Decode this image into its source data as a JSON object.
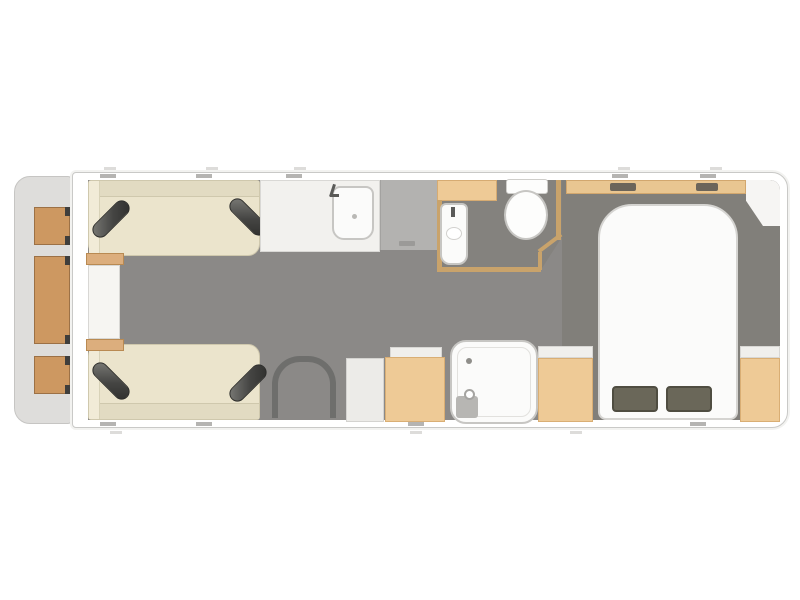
{
  "floorplan": {
    "type": "caravan-floorplan",
    "view": "top-down",
    "colors": {
      "front_body": "#dedddb",
      "body_wall": "#ffffff",
      "wall_outline": "#c9c9c7",
      "floor": "#8b8987",
      "floor_bedroom": "#817f7a",
      "floor_washroom": "#84827e",
      "sofa": "#ebe4cc",
      "cushion_dark": "#454543",
      "wood_light": "#eeca96",
      "wood_front_chest": "#cd9861",
      "worktop": "#f2f1ee",
      "hob_gray": "#b3b2b0",
      "fixture_white": "#fbfbfa",
      "pillow": "#6a6759",
      "wall_tan": "#c9a36b",
      "door_arch": "#6e6e6c"
    },
    "zones": [
      {
        "id": "front-lockers",
        "label": "front exterior chest lockers"
      },
      {
        "id": "lounge",
        "label": "front lounge with two facing sofas, bolster cushions and chest table"
      },
      {
        "id": "kitchen",
        "label": "kitchen with sink unit and worktop"
      },
      {
        "id": "washroom",
        "label": "washroom with vanity basin and toilet"
      },
      {
        "id": "entrance",
        "label": "arched entrance doorway"
      },
      {
        "id": "galley",
        "label": "fridge unit and dinette cabinet"
      },
      {
        "id": "shower",
        "label": "separate shower cubicle"
      },
      {
        "id": "wardrobe",
        "label": "wardrobe"
      },
      {
        "id": "bedroom",
        "label": "rear bedroom with island double bed, overhead shelf and bedside cabinets"
      }
    ],
    "fixtures": [
      {
        "id": "sofa-top",
        "label": "sofa"
      },
      {
        "id": "sofa-bottom",
        "label": "sofa"
      },
      {
        "id": "chest-table",
        "label": "chest table"
      },
      {
        "id": "kitchen-sink",
        "label": "sink with tap"
      },
      {
        "id": "hob-worktop",
        "label": "grey worktop section"
      },
      {
        "id": "vanity-basin",
        "label": "basin with tap"
      },
      {
        "id": "toilet",
        "label": "toilet with cistern"
      },
      {
        "id": "fridge",
        "label": "white cabinet"
      },
      {
        "id": "dinette-cabinet",
        "label": "wood cabinet"
      },
      {
        "id": "shower-tray",
        "label": "shower tray with drain and shower head"
      },
      {
        "id": "island-bed",
        "label": "island double bed with two pillows"
      },
      {
        "id": "overhead-shelf",
        "label": "overhead shelf"
      },
      {
        "id": "bedside-cabinet",
        "label": "bedside cabinet"
      }
    ]
  }
}
